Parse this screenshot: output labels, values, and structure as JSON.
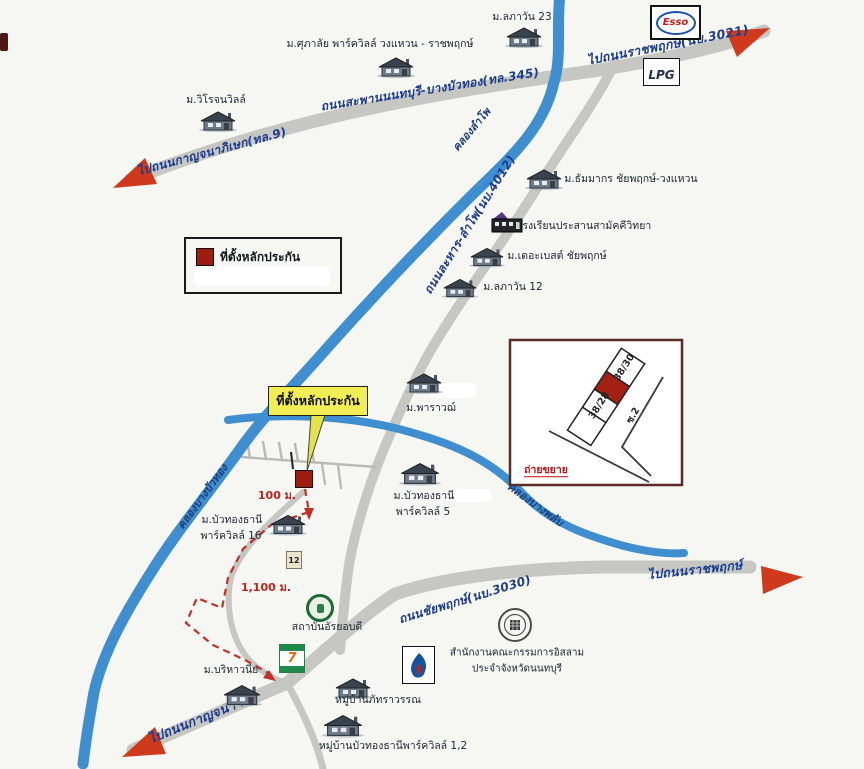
{
  "colors": {
    "canal": "#3e8ed0",
    "road": "#c6c6c3",
    "road_label": "#1e3d8f",
    "arrow": "#cf3a1c",
    "route_dashed": "#c03226",
    "collateral_red": "#9c1c12",
    "callout_yellow": "#f2ee53",
    "inset_red": "#a32014"
  },
  "legend": {
    "collateral_label": "ที่ตั้งหลักประกัน"
  },
  "callout": {
    "label": "ที่ตั้งหลักประกัน"
  },
  "roads": {
    "r345_left": "ไปถนนกาญจนาภิเษก(ทล.9)",
    "r345_mid": "ถนนสะพานนนทบุรี-บางบัวทอง(ทล.345)",
    "r345_right": "ไปถนนราชพฤกษ์(นบ.3021)",
    "r4012": "ถนนละหาร-ลำโพ(นบ.4012)",
    "chaiyapruek": "ถนนชัยพฤกษ์(นบ.3030)",
    "to_ratchaphruek": "ไปถนนราชพฤกษ์",
    "to_kanchana": "ไปถนนกาญจนาฯ"
  },
  "canals": {
    "lampho": "คลองลำโพ",
    "bangbuathong": "คลองบางบัวทอง",
    "bangphlap": "คลองบางพลับ"
  },
  "distances": {
    "d100": "100 ม.",
    "d1100": "1,100 ม."
  },
  "villages": [
    {
      "label": "ม.ลภาวัน 23"
    },
    {
      "label": "ม.ศุภาลัย พาร์ควิลล์ วงแหวน - ราชพฤกษ์"
    },
    {
      "label": "ม.วิโรจนวิลล์"
    },
    {
      "label": "ม.ธัมมากร ชัยพฤกษ์-วงแหวน"
    },
    {
      "label": "ม.เดอะเบสต์ ชัยพฤกษ์"
    },
    {
      "label": "ม.ลภาวัน 12"
    },
    {
      "label": "ม.พาราวฌ์"
    },
    {
      "label": "ม.บัวทองธานี",
      "label2": "พาร์ควิลล์ 5"
    },
    {
      "label": "ม.บัวทองธานี",
      "label2": "พาร์ควิลล์ 16"
    },
    {
      "label": "ม.บริหาวนีย"
    },
    {
      "label": "หมู่บ้านภัทราวรรณ"
    },
    {
      "label": "หมู่บ้านบัวทองธานีพาร์ควิลล์ 1,2"
    }
  ],
  "pois": {
    "school": "โรงเรียนประสานสามัคคีวิทยา",
    "esso": "Esso",
    "lpg": "LPG",
    "seven": "7",
    "institute": "สถาบันอัรยอบดี",
    "islamic_line1": "สำนักงานคณะกรรมการอิสลาม",
    "islamic_line2": "ประจำจังหวัดนนทบุรี",
    "marker_12": "12"
  },
  "inset": {
    "plot_top": "38/30",
    "plot_mid": "38/28",
    "soi": "ซ.2",
    "caption": "ถ่ายขยาย"
  }
}
